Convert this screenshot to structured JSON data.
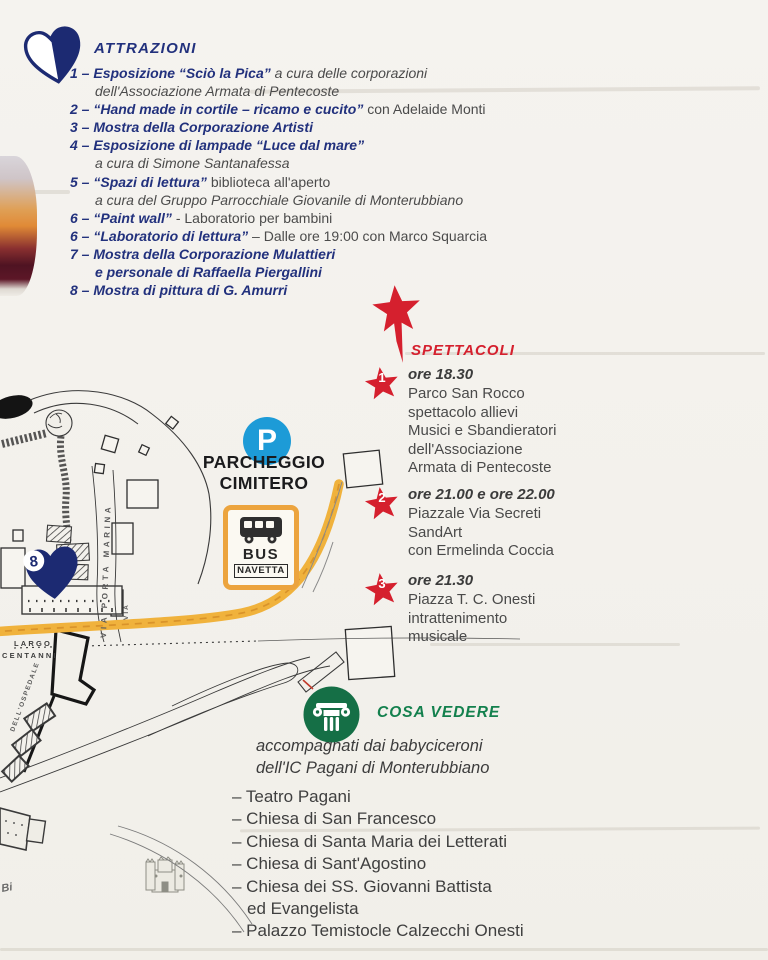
{
  "colors": {
    "blue": "#22317d",
    "red": "#d5202e",
    "green": "#13804d",
    "parking_blue": "#1d9bd7",
    "road_yellow": "#f0b23c",
    "sign_orange": "#eca43e",
    "body_text": "#4a4a4a"
  },
  "attractions": {
    "title": "ATTRAZIONI",
    "rows": [
      {
        "b": "1 – Esposizione “Sciò la Pica”",
        "ri": " a cura delle corporazioni"
      },
      {
        "ri": "dell'Associazione Armata di Pentecoste"
      },
      {
        "b": "2 – “Hand made in cortile –  ricamo e cucito”",
        "r": " con Adelaide Monti"
      },
      {
        "b": "3 – Mostra della Corporazione Artisti"
      },
      {
        "b": "4 – Esposizione di lampade “Luce dal mare”"
      },
      {
        "ri": "a cura di Simone Santanafessa"
      },
      {
        "b": "5 – “Spazi di lettura”",
        "r": " biblioteca all'aperto"
      },
      {
        "ri": "a cura del Gruppo Parrocchiale Giovanile di Monterubbiano"
      },
      {
        "b": "6 – “Paint wall”",
        "r": " - Laboratorio per bambini"
      },
      {
        "b": "6 – “Laboratorio di lettura”",
        "r": " – Dalle ore 19:00 con Marco Squarcia"
      },
      {
        "b": "7 – Mostra della Corporazione Mulattieri"
      },
      {
        "b": "e personale di Raffaella Piergallini"
      },
      {
        "b": "8 – Mostra di pittura di G. Amurri"
      }
    ]
  },
  "spettacoli": {
    "title": "SPETTACOLI",
    "items": [
      {
        "num": "1",
        "time": "ore 18.30",
        "body": "Parco San Rocco\nspettacolo allievi\nMusici e Sbandieratori\ndell'Associazione\nArmata di Pentecoste"
      },
      {
        "num": "2",
        "time": "ore 21.00 e ore 22.00",
        "body": "Piazzale Via Secreti\nSandArt\ncon Ermelinda Coccia"
      },
      {
        "num": "3",
        "time": "ore 21.30",
        "body": "Piazza T. C. Onesti\nintrattenimento\nmusicale"
      }
    ]
  },
  "map": {
    "parking_letter": "P",
    "parking_label": "PARCHEGGIO\nCIMITERO",
    "bus_line1": "BUS",
    "bus_line2": "NAVETTA",
    "pin_number": "8",
    "labels": {
      "via_porta_marina": "VIA PORTA MARINA",
      "largo": "LARGO",
      "centanni": "CENTANNI",
      "dell_ospedale": "DELL'OSPEDALE",
      "via": "VIA",
      "bi": "Bi"
    }
  },
  "cosa_vedere": {
    "title": "COSA VEDERE",
    "intro": "accompagnati dai babyciceroni\ndell'IC Pagani di Monterubbiano",
    "places": [
      "– Teatro Pagani",
      "– Chiesa di San Francesco",
      "– Chiesa di Santa Maria dei Letterati",
      "– Chiesa di Sant'Agostino",
      "– Chiesa dei SS. Giovanni Battista",
      "ed Evangelista",
      "– Palazzo Temistocle Calzecchi Onesti"
    ]
  }
}
